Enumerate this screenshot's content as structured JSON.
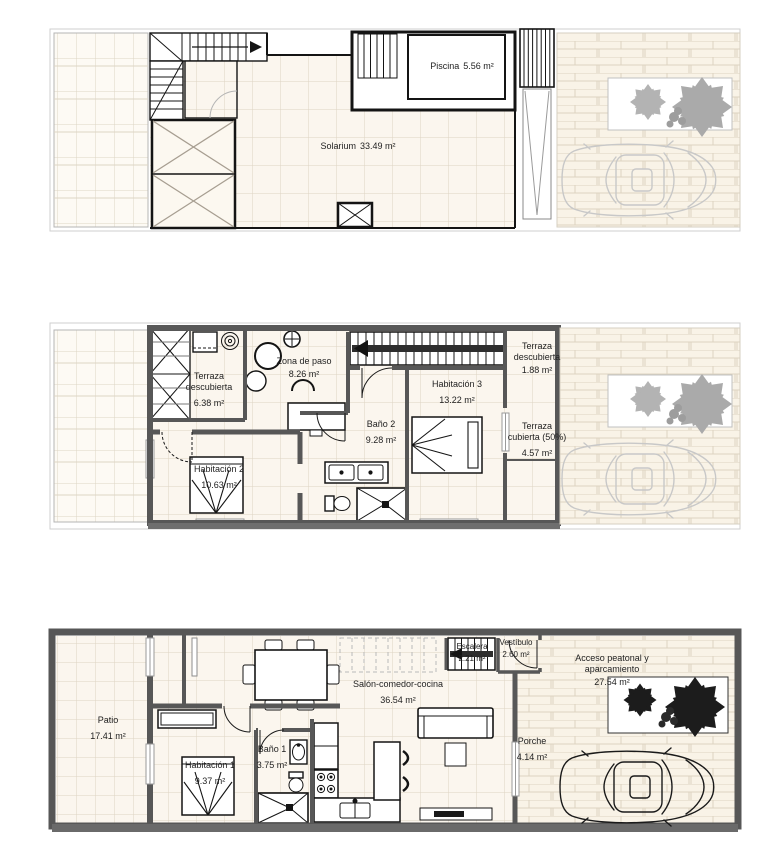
{
  "document": {
    "type": "architectural-floor-plans",
    "levels": [
      "solarium-roof-level",
      "first-floor",
      "ground-floor"
    ]
  },
  "palette": {
    "floor_tile": "#fbf6ee",
    "tile_line": "#ddd3c2",
    "wall_gray": "#575757",
    "line_black": "#1a1a1a",
    "faded_gray": "#c8c8c8",
    "exterior_paving": "#f9f3e7",
    "bush_gray": "#a8a8a8",
    "bush_dark": "#1c1c1c"
  },
  "floors": [
    {
      "id": "solarium-level",
      "rooms": [
        {
          "name": "Piscina",
          "area": "5.56 m²"
        },
        {
          "name": "Solarium",
          "area": "33.49 m²"
        }
      ]
    },
    {
      "id": "first-floor",
      "rooms": [
        {
          "name": "Terraza descubierta",
          "area": "6.38 m²"
        },
        {
          "name": "Zona de paso",
          "area": "8.26 m²"
        },
        {
          "name": "Habitación 2",
          "area": "10.63 m²"
        },
        {
          "name": "Baño 2",
          "area": "9.28 m²"
        },
        {
          "name": "Habitación 3",
          "area": "13.22 m²"
        },
        {
          "name": "Terraza descubierta",
          "area": "1.88 m²"
        },
        {
          "name": "Terraza cubierta (50%)",
          "area": "4.57 m²"
        }
      ]
    },
    {
      "id": "ground-floor",
      "rooms": [
        {
          "name": "Patio",
          "area": "17.41 m²"
        },
        {
          "name": "Habitación 1",
          "area": "9.37 m²"
        },
        {
          "name": "Baño 1",
          "area": "3.75 m²"
        },
        {
          "name": "Salón-comedor-cocina",
          "area": "36.54 m²"
        },
        {
          "name": "Escalera",
          "area": "2.21 m²"
        },
        {
          "name": "Vestíbulo",
          "area": "2.60 m²"
        },
        {
          "name": "Acceso peatonal y aparcamiento",
          "area": "27.54 m²"
        },
        {
          "name": "Porche",
          "area": "4.14 m²"
        }
      ]
    }
  ]
}
